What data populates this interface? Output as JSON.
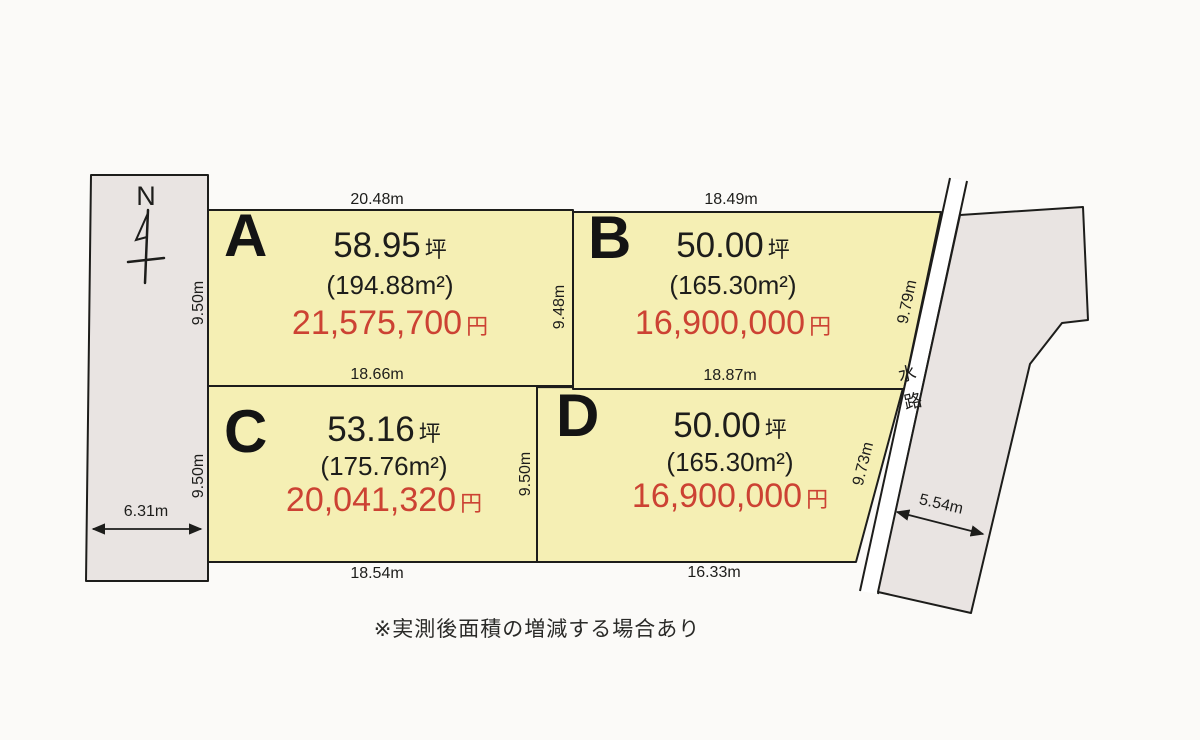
{
  "compass": {
    "label": "N"
  },
  "waterway": {
    "label": "水路"
  },
  "note": "※実測後面積の増減する場合あり",
  "plots": [
    {
      "id": "A",
      "label": "A",
      "area_tsubo": "58.95",
      "tsubo_unit": "坪",
      "area_m2": "(194.88m²)",
      "price": "21,575,700",
      "price_unit": "円"
    },
    {
      "id": "B",
      "label": "B",
      "area_tsubo": "50.00",
      "tsubo_unit": "坪",
      "area_m2": "(165.30m²)",
      "price": "16,900,000",
      "price_unit": "円"
    },
    {
      "id": "C",
      "label": "C",
      "area_tsubo": "53.16",
      "tsubo_unit": "坪",
      "area_m2": "(175.76m²)",
      "price": "20,041,320",
      "price_unit": "円"
    },
    {
      "id": "D",
      "label": "D",
      "area_tsubo": "50.00",
      "tsubo_unit": "坪",
      "area_m2": "(165.30m²)",
      "price": "16,900,000",
      "price_unit": "円"
    }
  ],
  "dimensions": {
    "plot_a_top": "20.48m",
    "plot_b_top": "18.49m",
    "plot_a_bottom": "18.66m",
    "plot_b_bottom": "18.87m",
    "plot_c_bottom": "18.54m",
    "plot_d_bottom": "16.33m",
    "plot_a_left": "9.50m",
    "plot_b_left": "9.48m",
    "plot_b_right": "9.79m",
    "plot_c_left": "9.50m",
    "plot_c_right": "9.50m",
    "plot_d_right": "9.73m",
    "road_width": "6.31m",
    "east_parcel_width": "5.54m"
  },
  "colors": {
    "plot_fill": "#f5efb4",
    "parcel_fill": "#e9e4e2",
    "outline": "#1d1d1b",
    "price_red": "#cc4233",
    "background": "#fbfaf8"
  }
}
